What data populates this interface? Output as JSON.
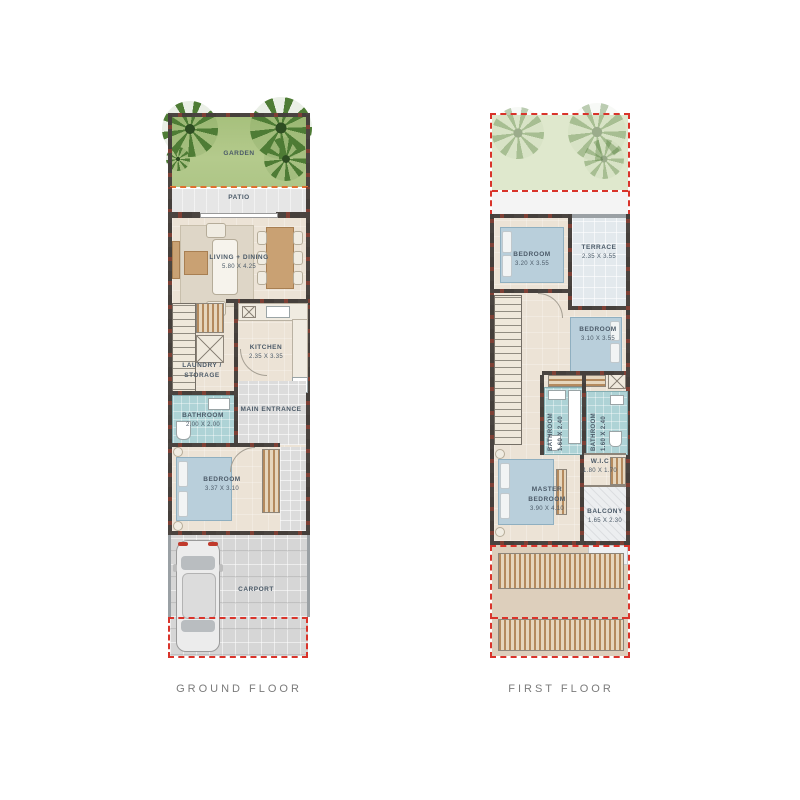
{
  "ground_floor": {
    "title": "GROUND FLOOR",
    "garden": "GARDEN",
    "patio": "PATIO",
    "living": {
      "name": "LIVING + DINING",
      "dims": "5.80 X 4.25"
    },
    "kitchen": {
      "name": "KITCHEN",
      "dims": "2.35 X 3.35"
    },
    "laundry": {
      "name": "LAUNDRY / STORAGE"
    },
    "bathroom": {
      "name": "BATHROOM",
      "dims": "2.00 X 2.00"
    },
    "entrance": {
      "name": "MAIN ENTRANCE"
    },
    "bedroom": {
      "name": "BEDROOM",
      "dims": "3.37 X 3.10"
    },
    "carport": {
      "name": "CARPORT"
    }
  },
  "first_floor": {
    "title": "FIRST FLOOR",
    "bedroom1": {
      "name": "BEDROOM",
      "dims": "3.20 X 3.55"
    },
    "terrace": {
      "name": "TERRACE",
      "dims": "2.35 X 3.55"
    },
    "bedroom2": {
      "name": "BEDROOM",
      "dims": "3.10 X 3.55"
    },
    "bathroom1": {
      "name": "BATHROOM",
      "dims": "1.60 X 2.40"
    },
    "bathroom2": {
      "name": "BATHROOM",
      "dims": "1.60 X 2.40"
    },
    "wic": {
      "name": "W.I.C",
      "dims": "1.80 X 1.70"
    },
    "master": {
      "name": "MASTER BEDROOM",
      "dims": "3.90 X 4.10"
    },
    "balcony": {
      "name": "BALCONY",
      "dims": "1.65 X 2.30"
    }
  },
  "colors": {
    "wall": "#4a4440",
    "wall_accent": "#7e4035",
    "garden_green": "#aec687",
    "garden_faded": "#dfe8cd",
    "patio_gray": "#e6e6e6",
    "floor_beige": "#ece3d6",
    "bathroom_teal": "#aed3d6",
    "terrace_gray": "#e3e9ed",
    "roof_beige": "#ddcfbc",
    "slat_wood": "#b48a5e",
    "boundary_red": "#d9342b",
    "patio_line_orange": "#e0702f",
    "room_label_text": "#4b5a68",
    "caption_text": "#7b7b7b"
  }
}
